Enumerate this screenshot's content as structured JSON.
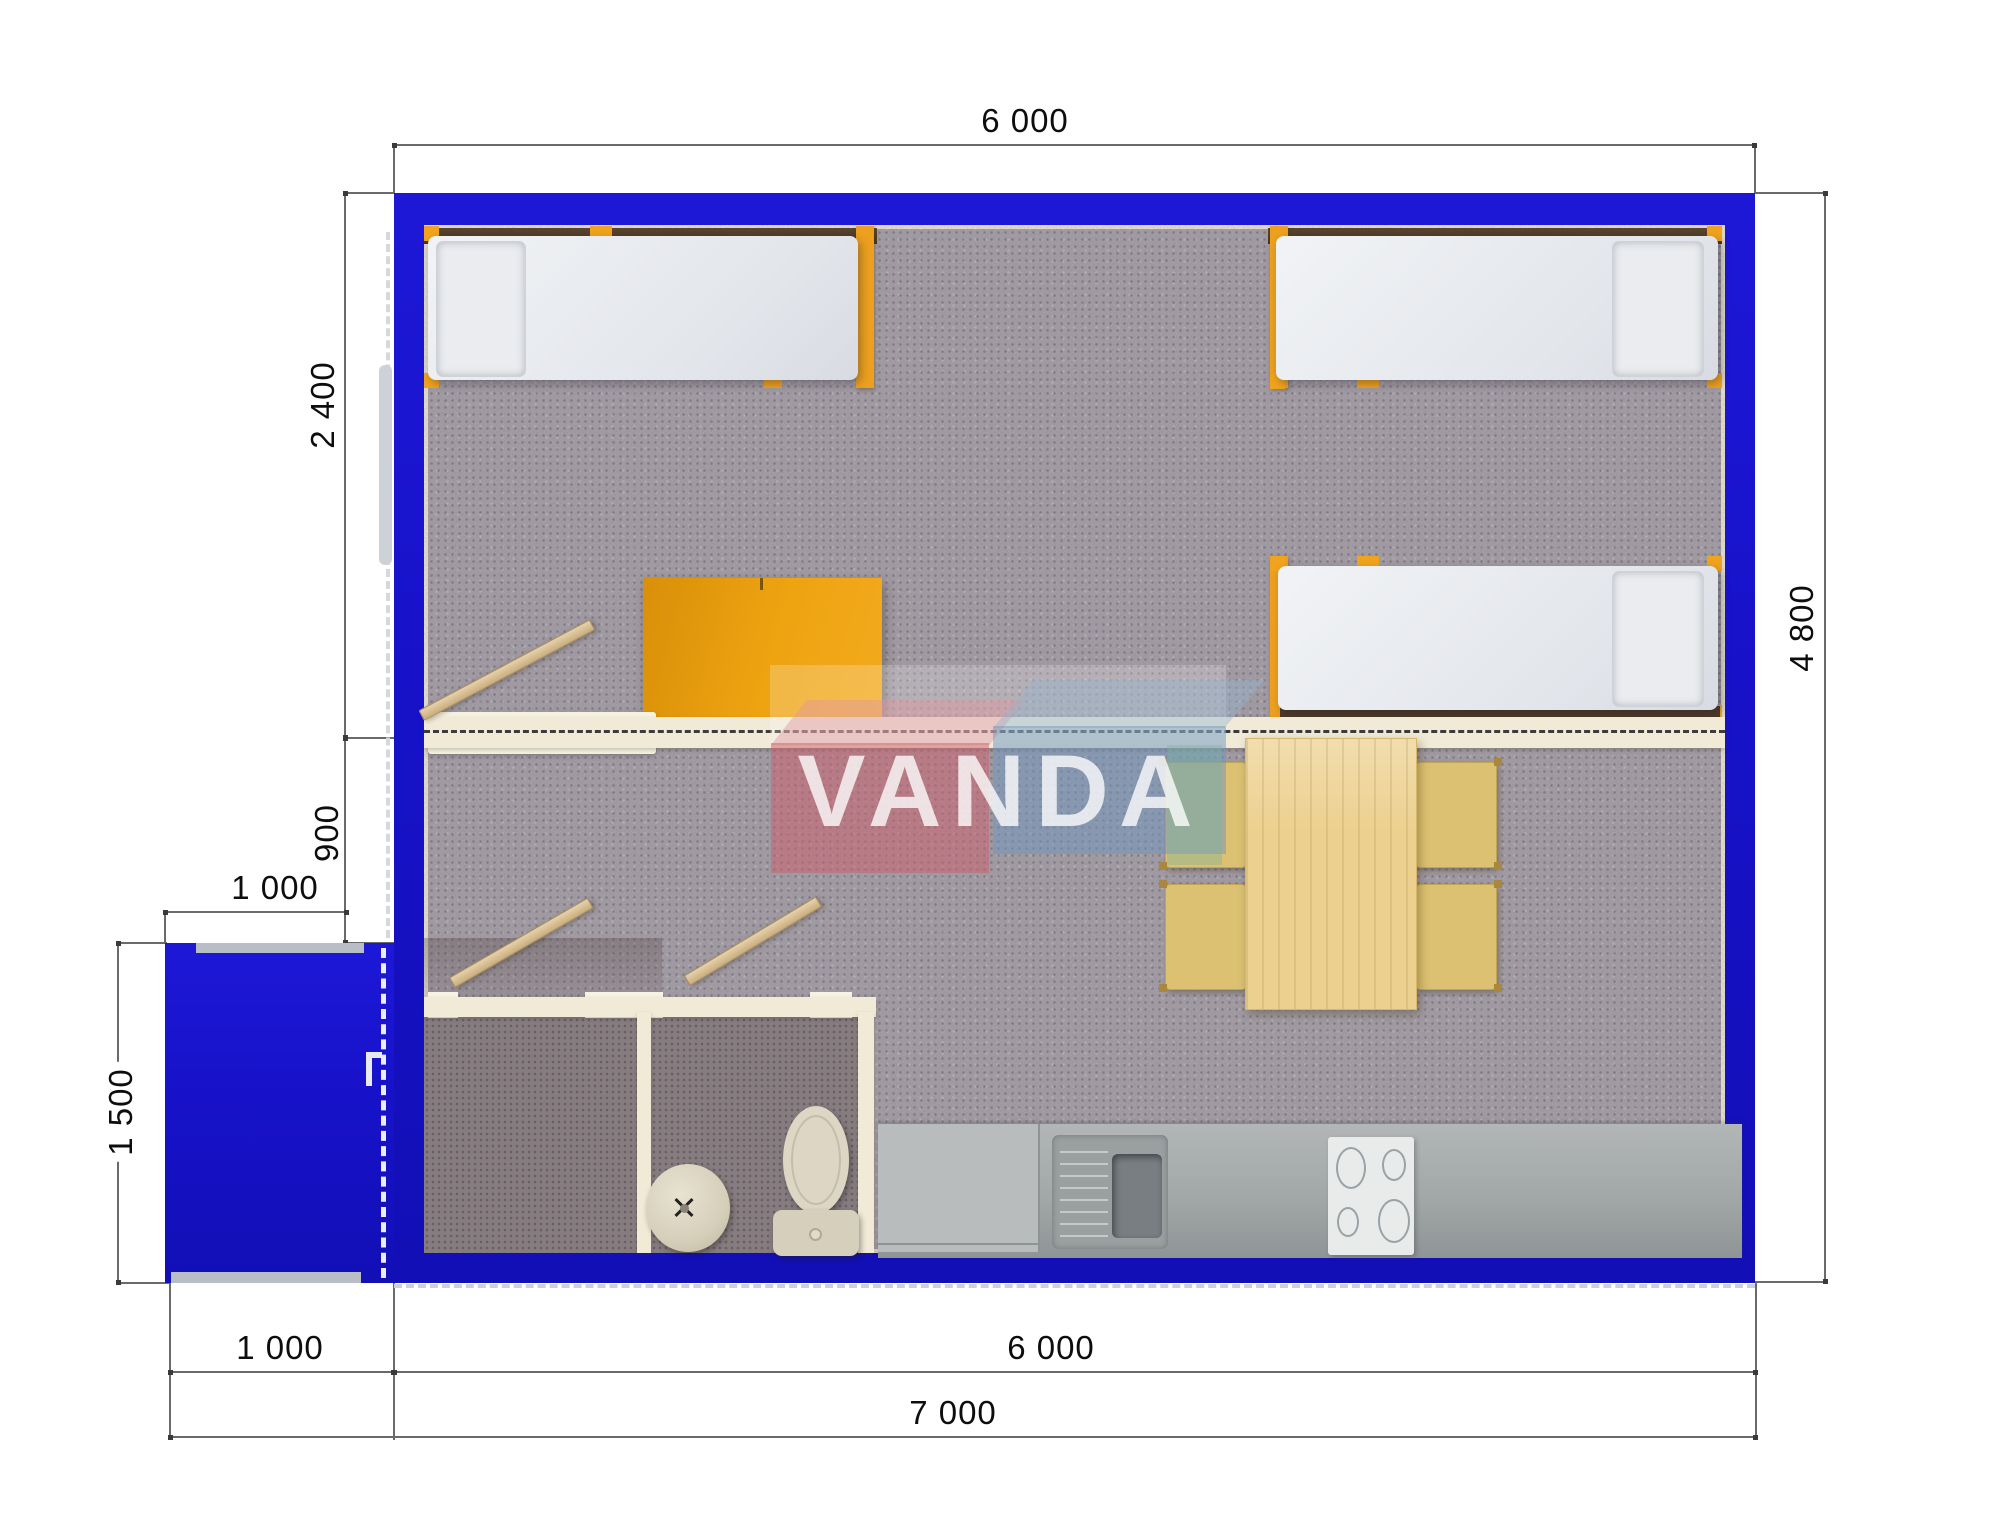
{
  "watermark": {
    "text": "VANDA",
    "box_left_color": "#d06f7e",
    "box_right_color": "#6f93bd"
  },
  "dimensions": {
    "top_width": "6 000",
    "left_bedroom_depth": "2 400",
    "left_hall_depth": "900",
    "porch_width_top": "1 000",
    "porch_depth": "1 500",
    "bottom_porch_width": "1 000",
    "bottom_building_width": "6 000",
    "bottom_total_width": "7 000",
    "right_building_depth": "4 800"
  },
  "palette": {
    "wall_blue": "#1712c9",
    "carpet_gray": "#a7a1a8",
    "bathroom_floor": "#8a8083",
    "partition_cream": "#f0ead6",
    "bed_frame_orange": "#eda01f",
    "headboard_brown": "#53402b",
    "wardrobe_amber": "#eea411",
    "table_wood": "#ecd08f",
    "chair_mustard": "#dcc172",
    "counter_gray": "#a6abab",
    "fixture_cream": "#ddd6c4"
  },
  "furniture": {
    "beds": [
      "single-bed-top-left",
      "single-bed-top-right",
      "single-bed-middle-right"
    ],
    "items": [
      "wardrobe",
      "dining-table",
      "four-chairs",
      "kitchen-counter",
      "kitchen-sink",
      "cooktop",
      "toilet",
      "wash-basin",
      "porch",
      "bathroom",
      "shower-room"
    ]
  }
}
